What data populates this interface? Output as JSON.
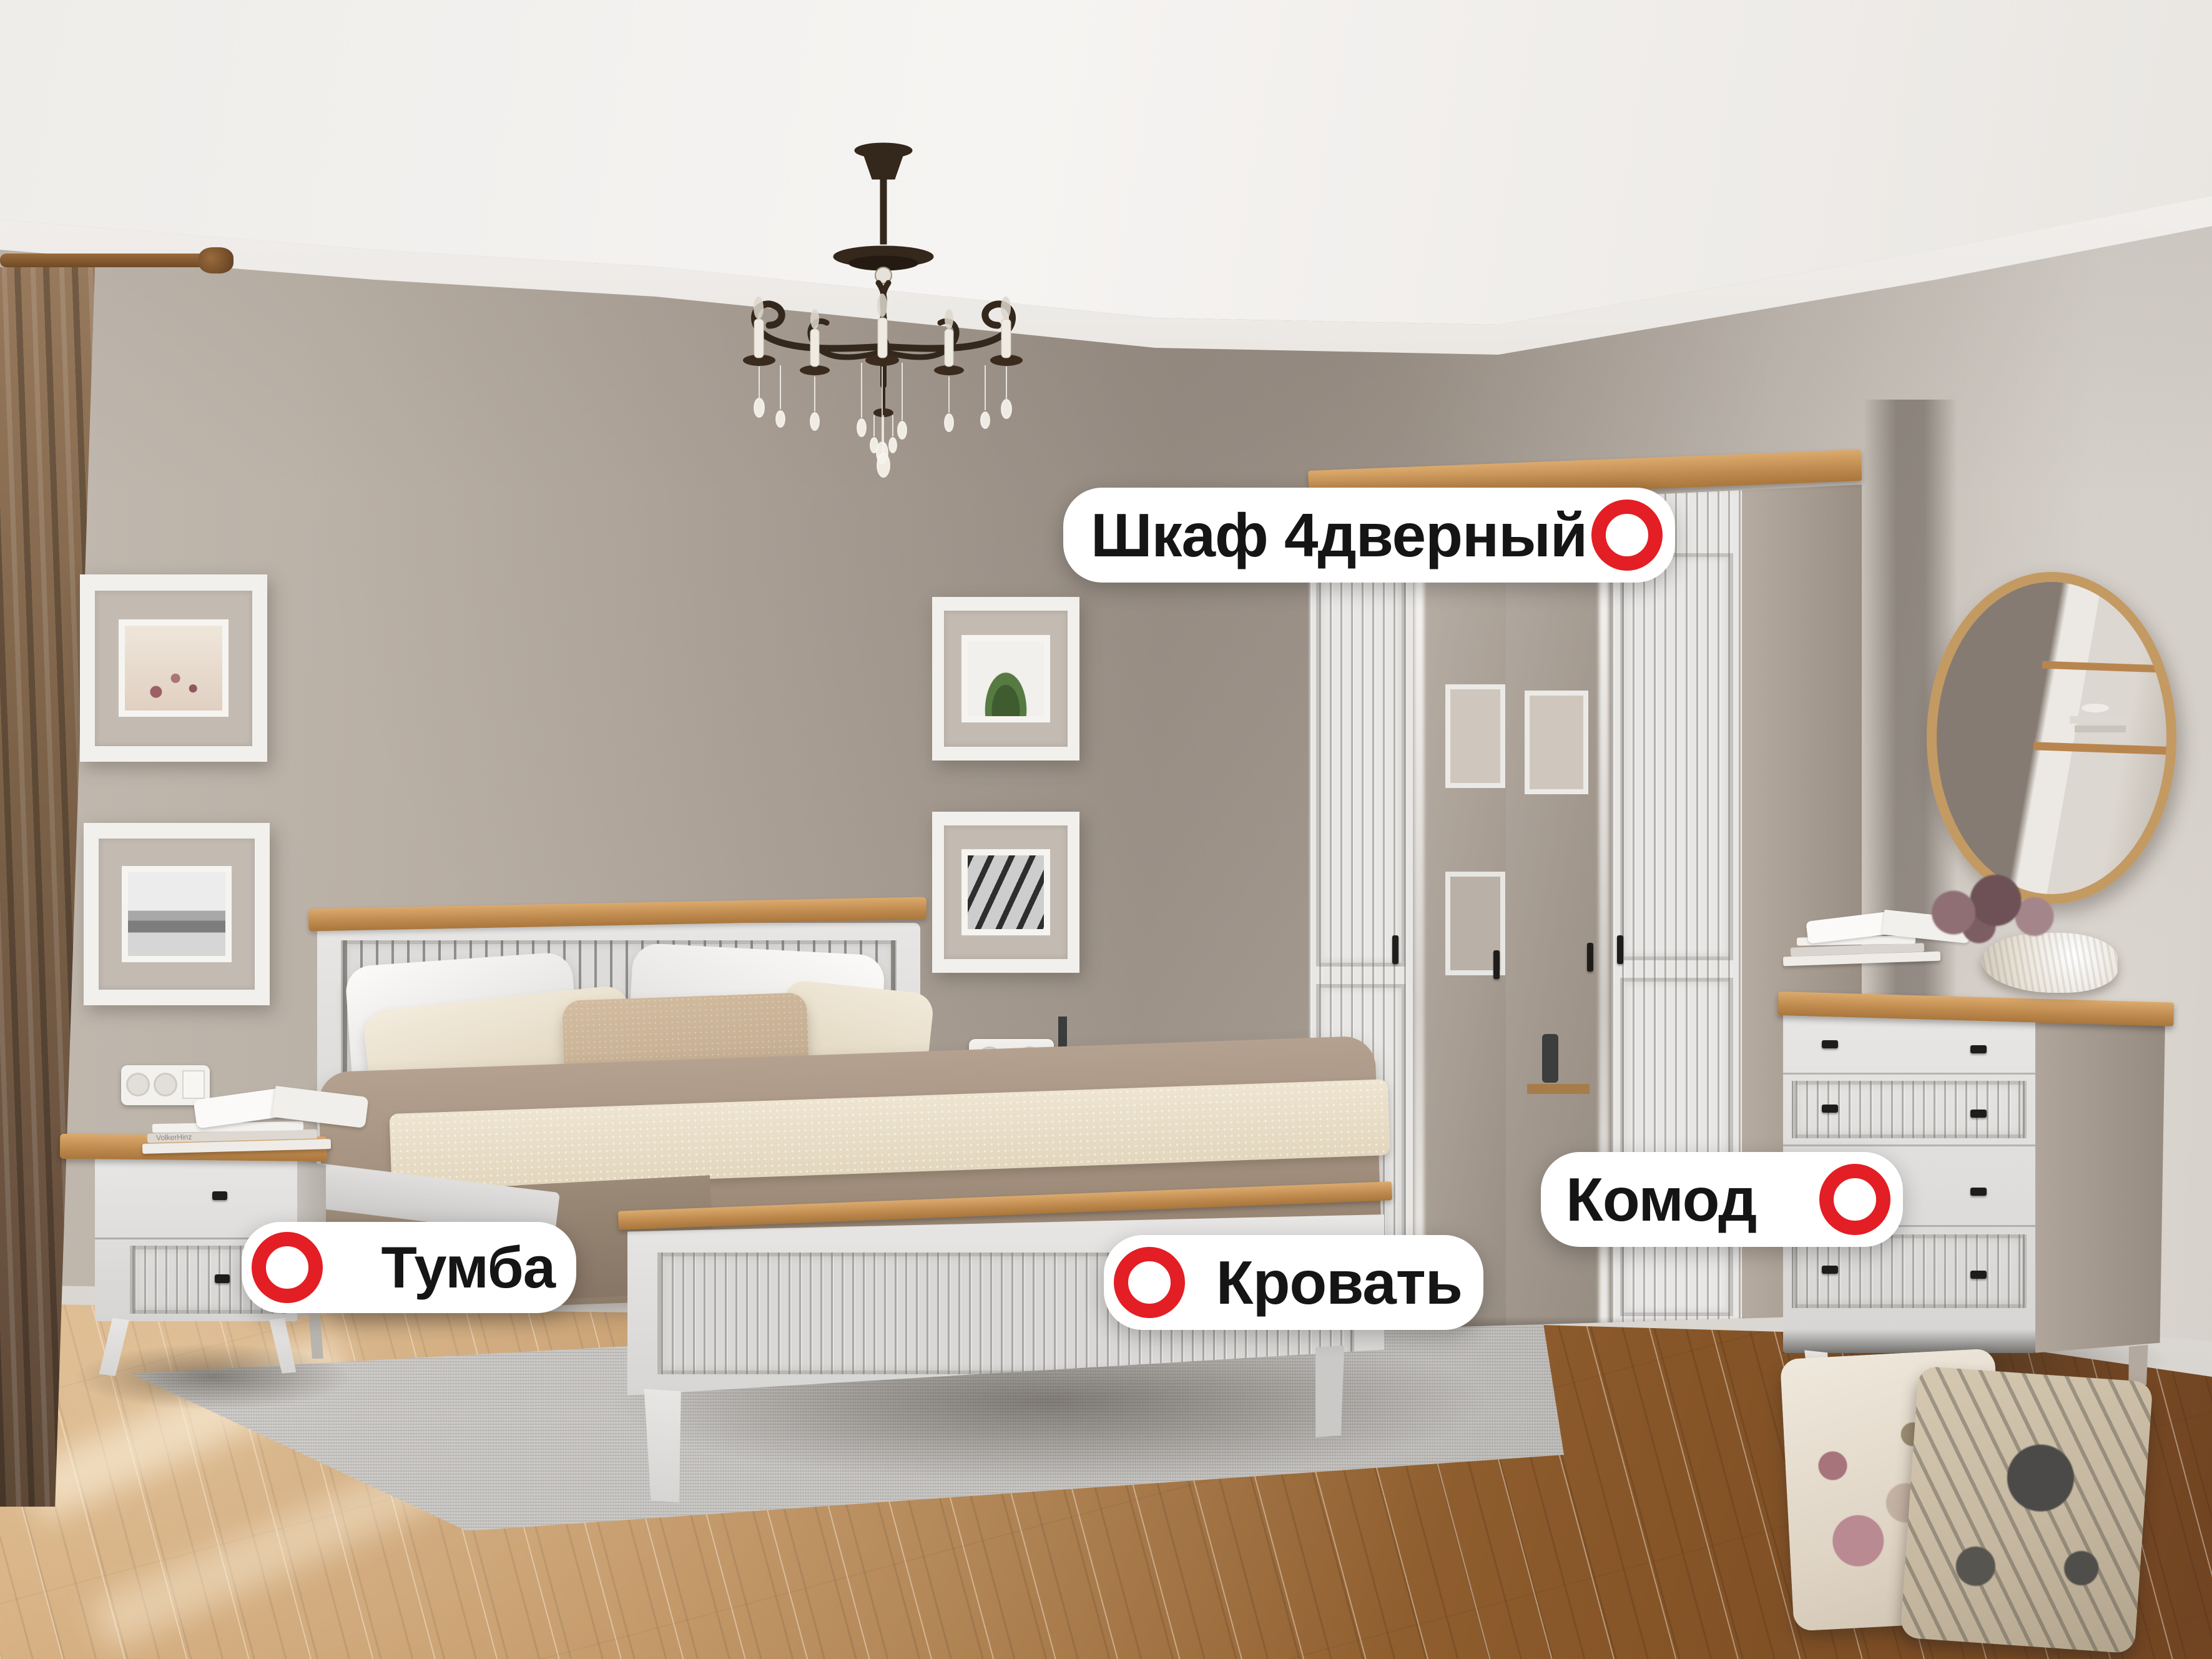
{
  "page": {
    "kind": "annotated-furniture-showroom-photo",
    "language": "ru",
    "room": "bedroom"
  },
  "labels": {
    "wardrobe": {
      "text": "Шкаф 4дверный",
      "marker_side": "right"
    },
    "bed": {
      "text": "Кровать",
      "marker_side": "left"
    },
    "nightstand": {
      "text": "Тумба",
      "marker_side": "left"
    },
    "dresser": {
      "text": "Комод",
      "marker_side": "right"
    }
  },
  "markers": {
    "shape": "ring",
    "color": "#e31e24",
    "inner": "#ffffff",
    "background": "#ffffff",
    "text_color": "#151515"
  },
  "decor": {
    "book_spine_text": "VolkerHinz"
  },
  "colors": {
    "wall": "#b3a99f",
    "wall_light": "#d9d4ce",
    "ceiling": "#f2f0ee",
    "molding": "#f6f4f1",
    "floor_light": "#c89a62",
    "floor_dark": "#855427",
    "rug": "#c7c5c2",
    "furniture_white": "#e3e2e0",
    "oak_trim": "#c08b4f",
    "curtain_brown": "#7c6248",
    "bedding_taupe": "#a6937f",
    "runner_cream": "#e9dfca",
    "pillow_beige": "#c2ab8f",
    "chandelier_bronze": "#3a2b1e"
  }
}
